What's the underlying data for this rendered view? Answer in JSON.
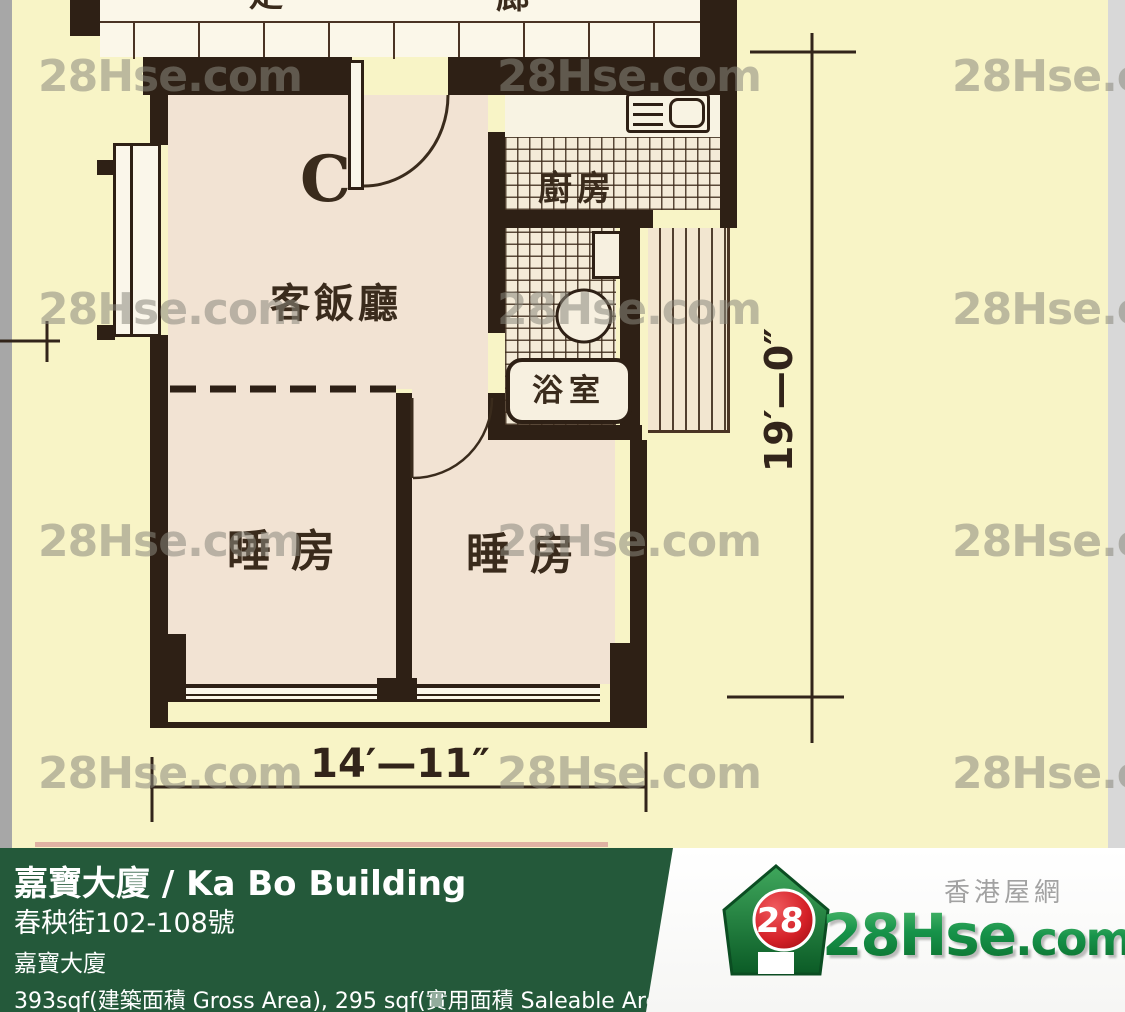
{
  "plan": {
    "unit_label": "C",
    "rooms": {
      "living": "客飯廳",
      "kitchen": "廚房",
      "bath": "浴室",
      "bed1": "睡房",
      "bed2": "睡房"
    },
    "corridor": {
      "char1": "走",
      "char2": "廊"
    },
    "dimensions": {
      "width": "14′—11″",
      "height": "19′—0″"
    }
  },
  "watermark": {
    "text": "28Hse.com"
  },
  "footer": {
    "title": "嘉寶大廈 / Ka Bo Building",
    "address": "春秧街102-108號",
    "building": "嘉寶大廈",
    "area": "393sqf(建築面積 Gross Area), 295 sqf(實用面積 Saleable Area)"
  },
  "logo": {
    "badge": "28",
    "site_main": "28Hse",
    "site_suffix": ".com",
    "tagline": "香港屋網"
  },
  "colors": {
    "plan_background": "#F8F4C6",
    "room_fill": "#F2E3D3",
    "wall": "#2E2015",
    "footer_green": "#24593A",
    "logo_green": "#118A3E",
    "logo_red": "#C8151D",
    "watermark_gray": "#8A887E"
  }
}
